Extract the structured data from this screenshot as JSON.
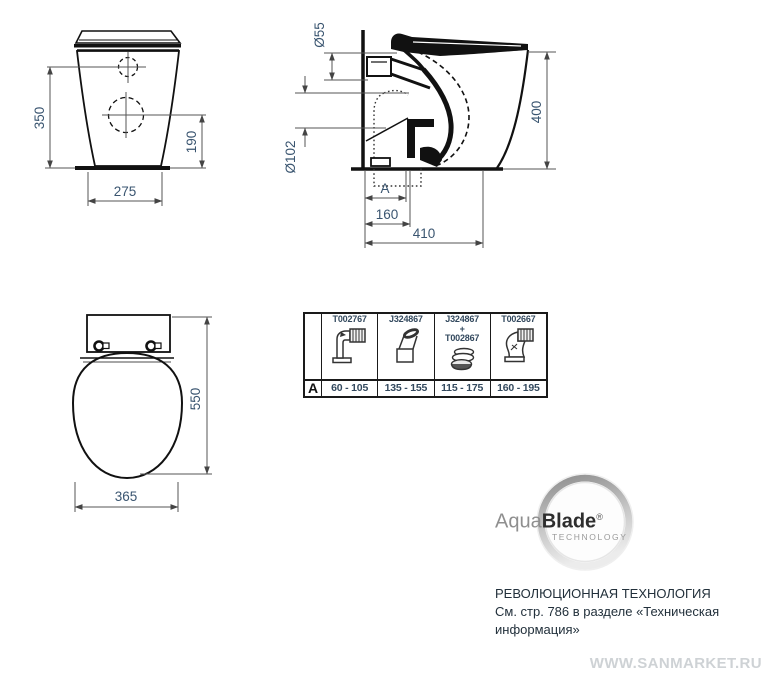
{
  "front_view": {
    "height": "350",
    "inlet_height": "190",
    "base_width": "275"
  },
  "side_view": {
    "spigot_diameter": "Ø55",
    "outlet_diameter": "Ø102",
    "height": "400",
    "rough_in_label": "A",
    "outlet_offset": "160",
    "depth": "410"
  },
  "top_view": {
    "depth": "550",
    "seat_width": "365"
  },
  "connector_table": {
    "row_label": "A",
    "columns": [
      {
        "code": "T002767",
        "range": "60 - 105",
        "icon": "elbow-corrugated-pipe-icon"
      },
      {
        "code": "J324867",
        "range": "135 - 155",
        "icon": "angled-connector-icon"
      },
      {
        "code": "J324867",
        "plus": "+",
        "code2": "T002867",
        "range": "115 - 175",
        "icon": "offset-ring-adapter-icon"
      },
      {
        "code": "T002667",
        "range": "160 - 195",
        "icon": "s-bend-corrugated-pipe-icon"
      }
    ]
  },
  "logo": {
    "brand_aqua": "Aqua",
    "brand_blade": "Blade",
    "registered": "®",
    "subtitle": "TECHNOLOGY"
  },
  "info": {
    "line1": "РЕВОЛЮЦИОННАЯ ТЕХНОЛОГИЯ",
    "line2": "См. стр. 786 в разделе «Техническая",
    "line3": "информация»"
  },
  "watermark": "WWW.SANMARKET.RU",
  "colors": {
    "dimension_text": "#3a5570",
    "drawing_line": "#111111",
    "table_text": "#33495e",
    "info_text": "#22303b",
    "watermark": "#ced2d5"
  }
}
